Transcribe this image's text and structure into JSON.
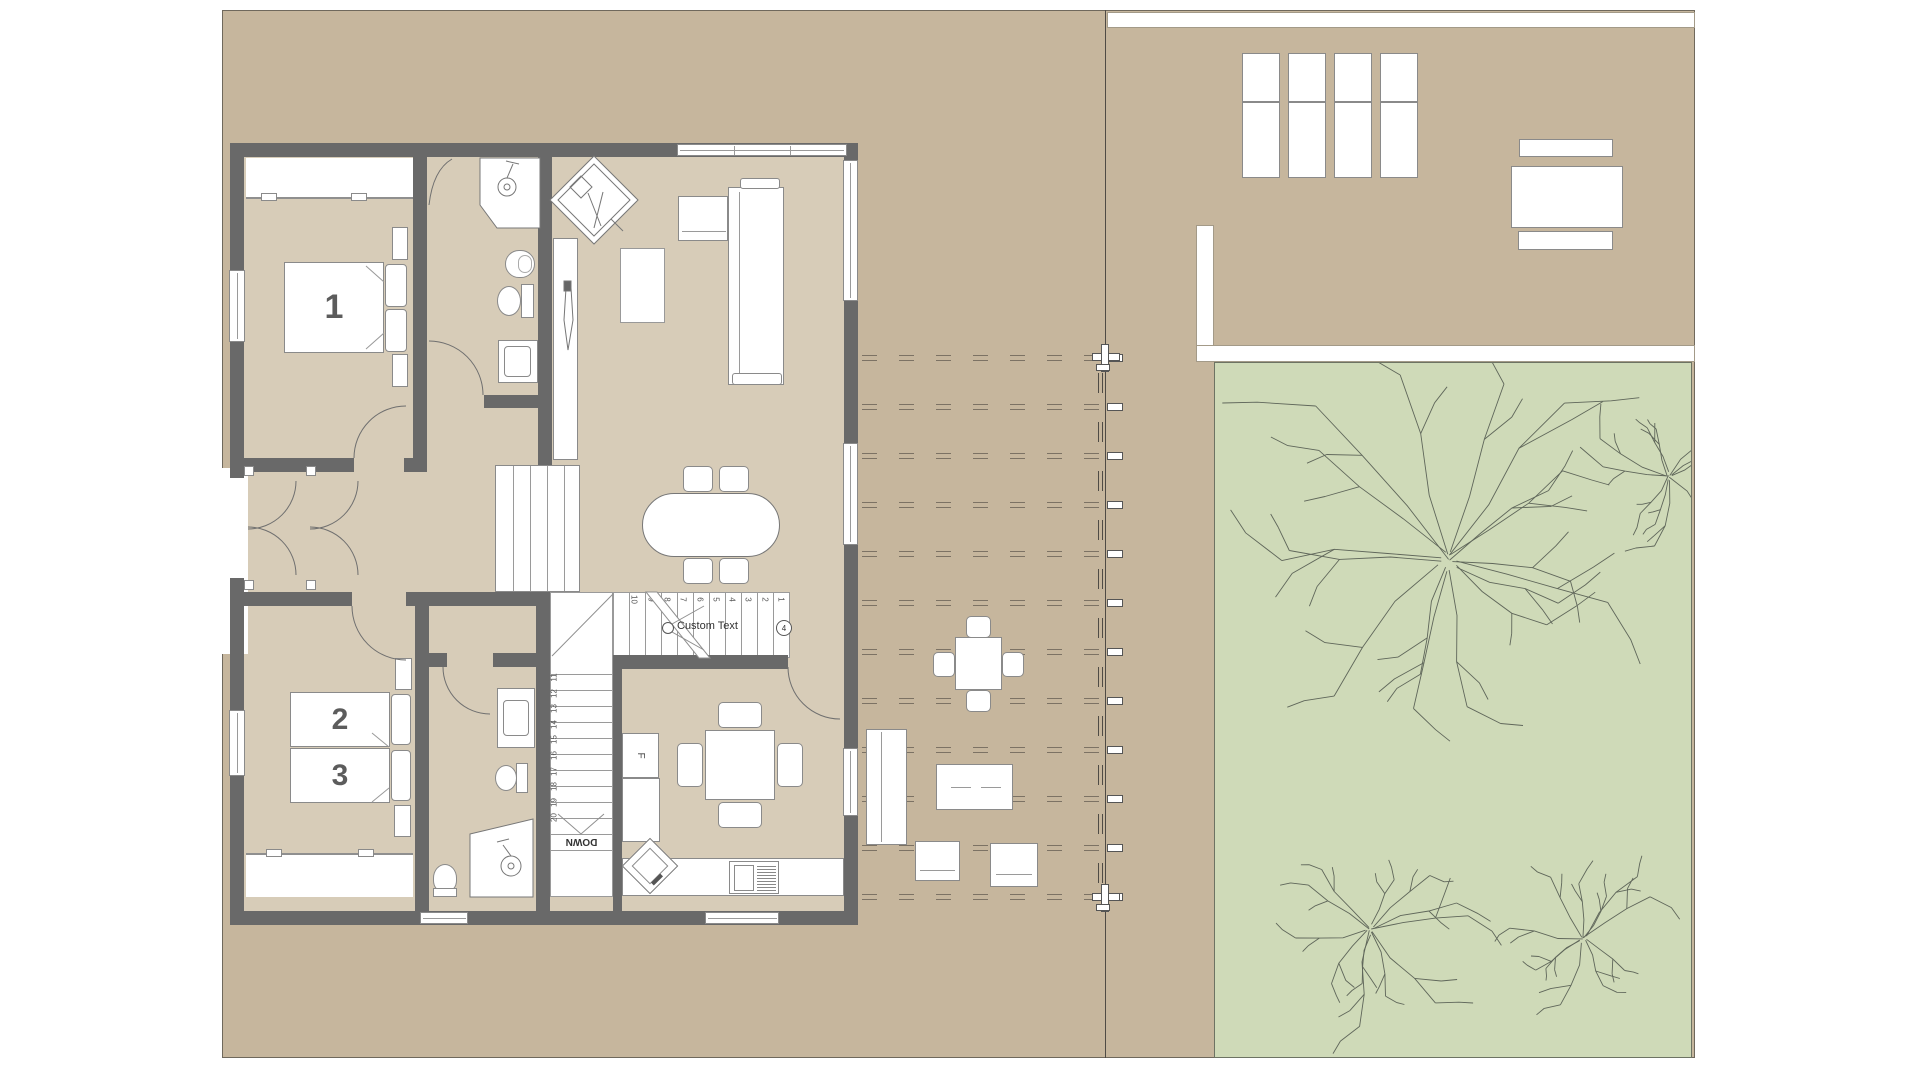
{
  "plan": {
    "bed_labels": {
      "master": "1",
      "twin_a": "2",
      "twin_b": "3"
    },
    "stairs": {
      "down": "DOWN",
      "custom_annotation": "Custom Text",
      "marker": "4",
      "upper_treads": [
        "1",
        "2",
        "3",
        "4",
        "5",
        "6",
        "7",
        "8",
        "9",
        "10"
      ],
      "lower_treads": [
        "11",
        "12",
        "13",
        "14",
        "15",
        "16",
        "17",
        "18",
        "19",
        "20"
      ]
    },
    "kitchen_fridge": "F"
  },
  "colors": {
    "site": "#c6b69d",
    "floor": "#d7ccb8",
    "wall": "#696969",
    "lawn": "#cfdab8",
    "lawn_border": "#6d7363",
    "dash": "#7c7264",
    "fence": "#4f4b45",
    "tree": "#5f665a",
    "furniture_border": "#8a8a8a",
    "label": "#5c5c5c"
  }
}
